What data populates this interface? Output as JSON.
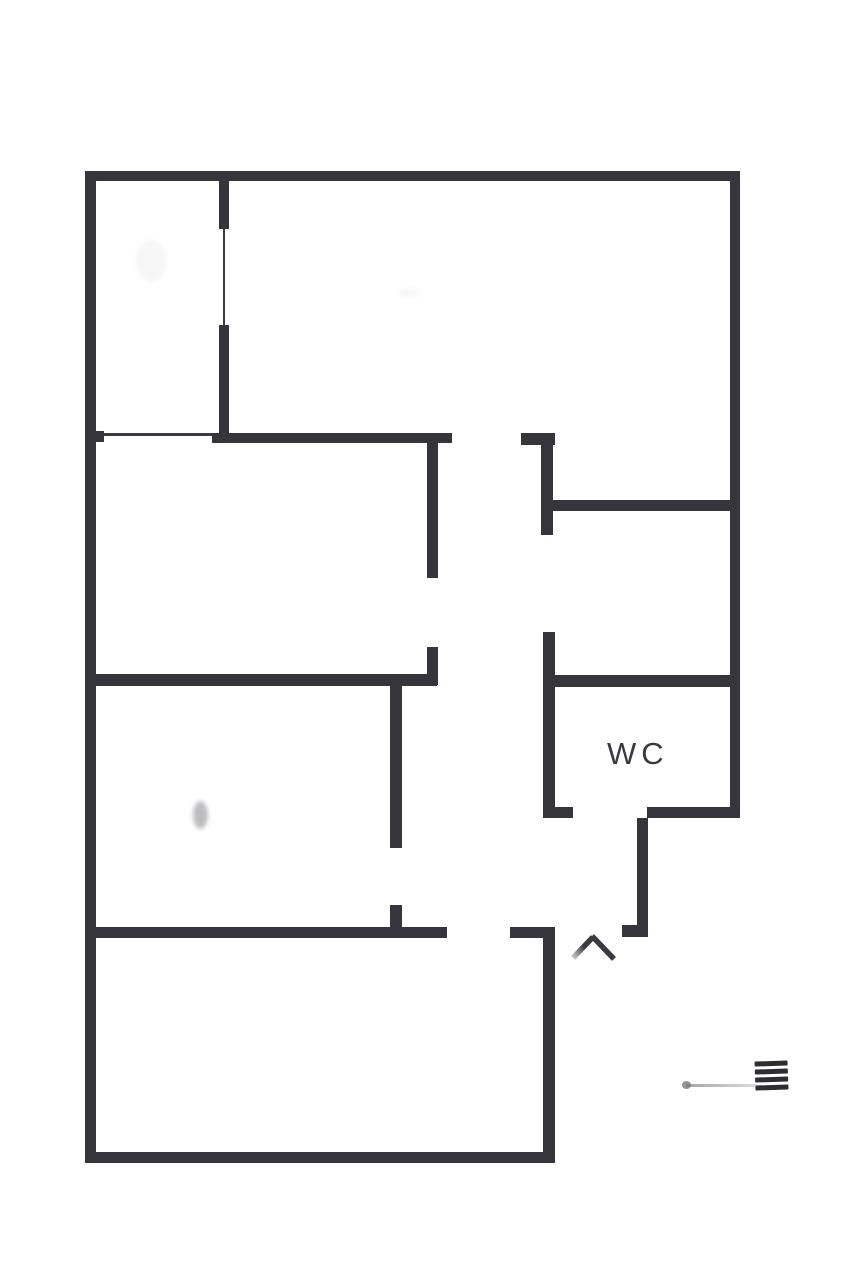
{
  "plan": {
    "type": "floor-plan",
    "background_color": "#ffffff",
    "wall_color": "#35353b",
    "text_color": "#3a3a40",
    "labels": {
      "wc": "WC"
    },
    "walls": [
      {
        "name": "outer-wall-top",
        "x": 85,
        "y": 171,
        "w": 655,
        "h": 10
      },
      {
        "name": "outer-wall-left",
        "x": 85,
        "y": 171,
        "w": 11,
        "h": 992
      },
      {
        "name": "outer-wall-right",
        "x": 730,
        "y": 171,
        "w": 10,
        "h": 647
      },
      {
        "name": "outer-wall-bottom",
        "x": 85,
        "y": 1152,
        "w": 470,
        "h": 11
      },
      {
        "name": "wall-room1-right-upper",
        "x": 219,
        "y": 171,
        "w": 10,
        "h": 58
      },
      {
        "name": "door-line-room1",
        "x": 223,
        "y": 229,
        "w": 2,
        "h": 96,
        "thin": true
      },
      {
        "name": "wall-room1-right-lower",
        "x": 219,
        "y": 325,
        "w": 10,
        "h": 118
      },
      {
        "name": "door-line-room2-top",
        "x": 96,
        "y": 433,
        "w": 116,
        "h": 3,
        "thin": true
      },
      {
        "name": "wall-left-nub",
        "x": 96,
        "y": 431,
        "w": 8,
        "h": 11
      },
      {
        "name": "wall-room2-top",
        "x": 212,
        "y": 433,
        "w": 240,
        "h": 10
      },
      {
        "name": "wall-hall-top-right",
        "x": 521,
        "y": 433,
        "w": 34,
        "h": 12
      },
      {
        "name": "wall-hall-right-upper",
        "x": 541,
        "y": 433,
        "w": 12,
        "h": 102
      },
      {
        "name": "wall-hall-left-upper",
        "x": 427,
        "y": 433,
        "w": 11,
        "h": 145
      },
      {
        "name": "wall-hall-left-stub",
        "x": 427,
        "y": 647,
        "w": 11,
        "h": 38
      },
      {
        "name": "wall-rightroom-divider",
        "x": 550,
        "y": 500,
        "w": 190,
        "h": 11
      },
      {
        "name": "wall-room2-bottom",
        "x": 85,
        "y": 674,
        "w": 352,
        "h": 12
      },
      {
        "name": "wall-wc-top",
        "x": 543,
        "y": 675,
        "w": 197,
        "h": 12
      },
      {
        "name": "wall-wc-left",
        "x": 543,
        "y": 632,
        "w": 12,
        "h": 186
      },
      {
        "name": "wall-wc-left-foot",
        "x": 543,
        "y": 807,
        "w": 30,
        "h": 11
      },
      {
        "name": "wall-wc-bottom-right",
        "x": 647,
        "y": 807,
        "w": 93,
        "h": 11
      },
      {
        "name": "wall-room3-right-upper",
        "x": 390,
        "y": 678,
        "w": 12,
        "h": 170
      },
      {
        "name": "wall-room3-right-stub",
        "x": 390,
        "y": 905,
        "w": 12,
        "h": 33
      },
      {
        "name": "wall-room4-top-left",
        "x": 85,
        "y": 927,
        "w": 362,
        "h": 11
      },
      {
        "name": "wall-room4-top-right",
        "x": 510,
        "y": 927,
        "w": 45,
        "h": 11
      },
      {
        "name": "wall-room4-right",
        "x": 543,
        "y": 927,
        "w": 12,
        "h": 236
      },
      {
        "name": "wall-entry-right",
        "x": 637,
        "y": 818,
        "w": 11,
        "h": 119
      },
      {
        "name": "wall-entry-right-foot",
        "x": 622,
        "y": 925,
        "w": 26,
        "h": 12
      }
    ],
    "entrance_marker": {
      "icon": "chevron-up-icon",
      "color": "#3a3a40"
    },
    "artifact": {
      "description": "small striped mark with faint line and dot",
      "stripe_count": 4,
      "color": "#2d2d33"
    }
  }
}
